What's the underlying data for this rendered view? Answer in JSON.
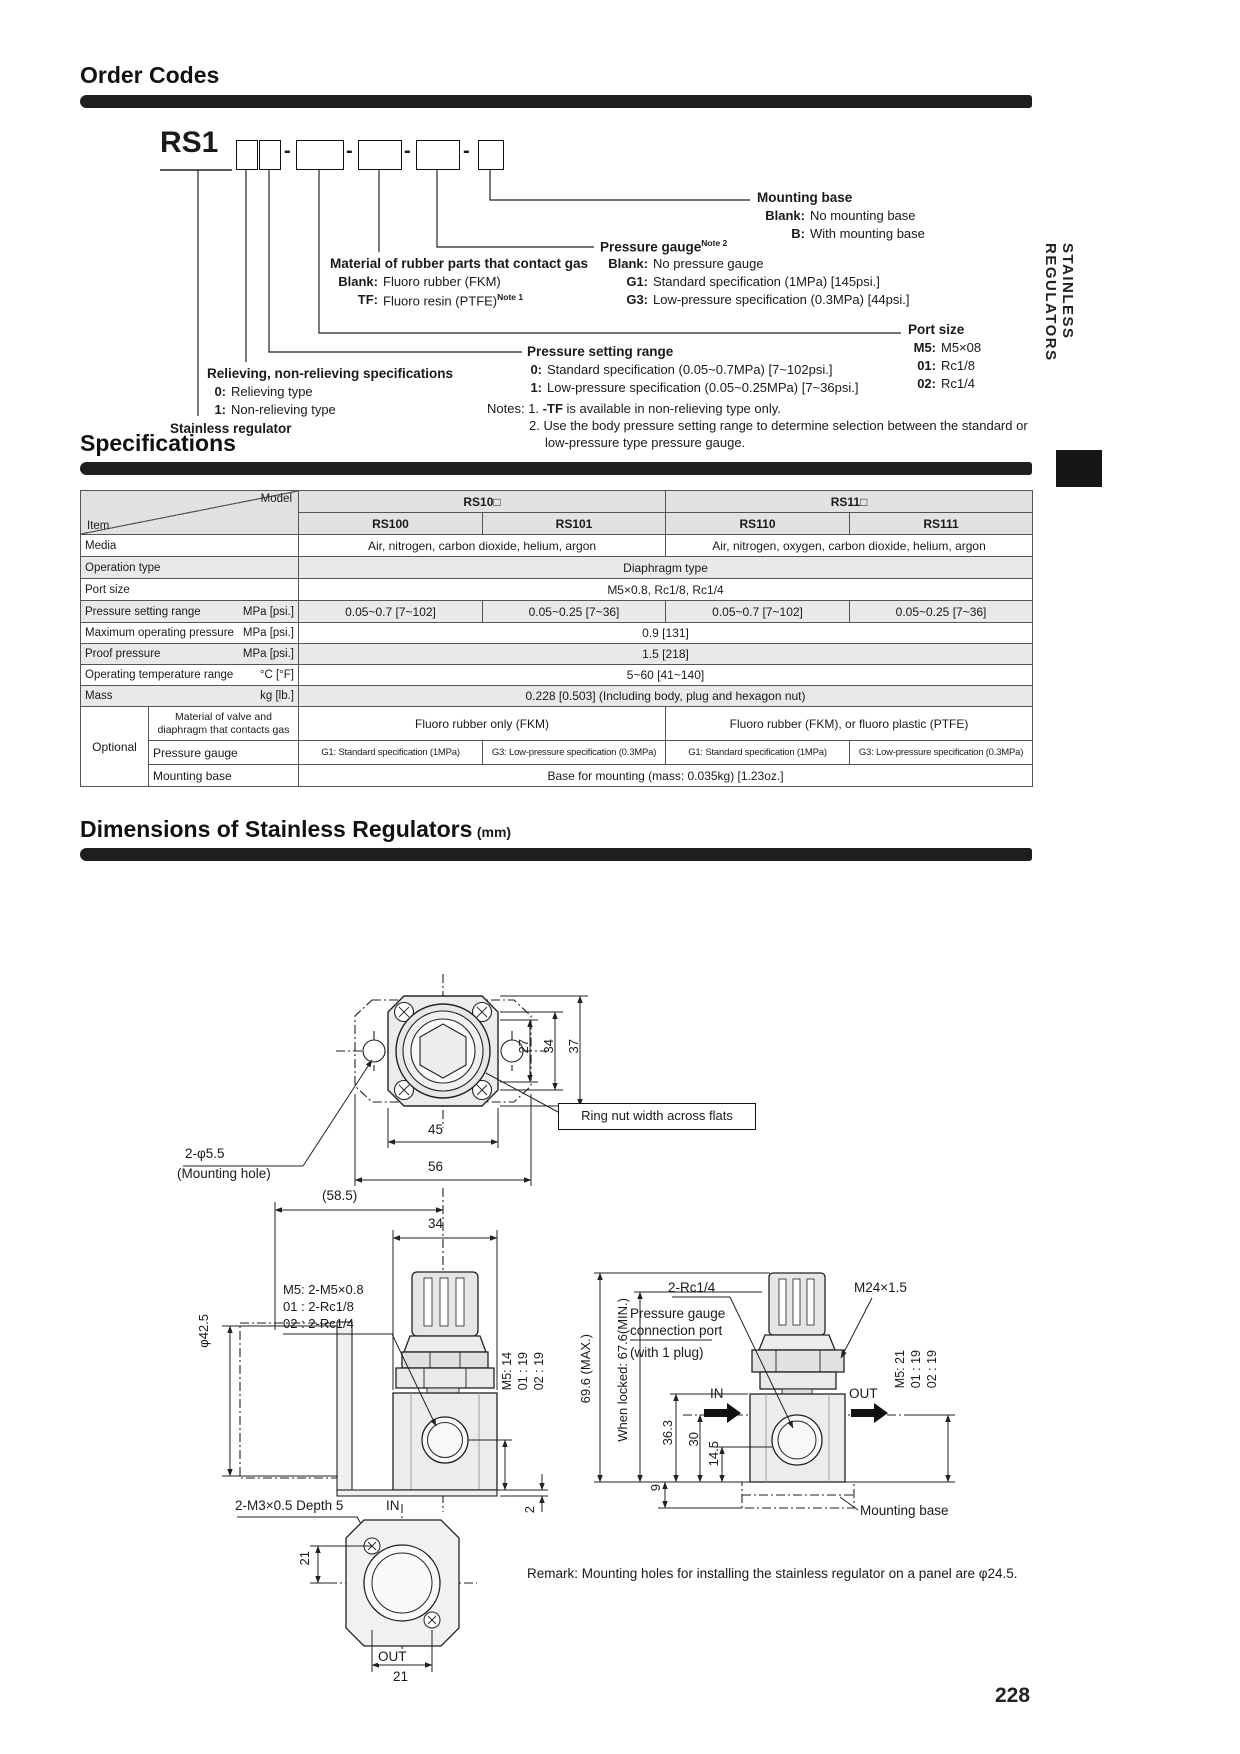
{
  "page": {
    "number": "228",
    "side_tab": "STAINLESS REGULATORS"
  },
  "order": {
    "title": "Order Codes",
    "prefix": "RS1",
    "dash": "-",
    "stainless_label": "Stainless regulator",
    "relieving": {
      "title": "Relieving, non-relieving specifications",
      "opts": [
        {
          "c": "0:",
          "t": "Relieving type"
        },
        {
          "c": "1:",
          "t": "Non-relieving type"
        }
      ]
    },
    "pressure_setting": {
      "title": "Pressure setting range",
      "opts": [
        {
          "c": "0:",
          "t": "Standard specification (0.05~0.7MPa) [7~102psi.]"
        },
        {
          "c": "1:",
          "t": "Low-pressure specification (0.05~0.25MPa) [7~36psi.]"
        }
      ]
    },
    "material": {
      "title": "Material of rubber parts that contact gas",
      "opts": [
        {
          "c": "Blank:",
          "t": "Fluoro rubber (FKM)"
        },
        {
          "c": "TF:",
          "t": "Fluoro resin (PTFE)",
          "sup": "Note 1"
        }
      ]
    },
    "pressure_gauge": {
      "title": "Pressure gauge",
      "sup": "Note 2",
      "opts": [
        {
          "c": "Blank:",
          "t": "No pressure gauge"
        },
        {
          "c": "G1:",
          "t": "Standard specification (1MPa) [145psi.]"
        },
        {
          "c": "G3:",
          "t": "Low-pressure specification (0.3MPa) [44psi.]"
        }
      ]
    },
    "port_size": {
      "title": "Port size",
      "opts": [
        {
          "c": "M5:",
          "t": "M5×08"
        },
        {
          "c": "01:",
          "t": "Rc1/8"
        },
        {
          "c": "02:",
          "t": "Rc1/4"
        }
      ]
    },
    "mounting_base": {
      "title": "Mounting base",
      "opts": [
        {
          "c": "Blank:",
          "t": "No mounting base"
        },
        {
          "c": "B:",
          "t": "With mounting base"
        }
      ]
    },
    "notes": {
      "label": "Notes:",
      "n1_num": "1.",
      "n1_bold": "-TF",
      "n1_rest": "is available in non-relieving type only.",
      "n2_num": "2.",
      "n2_line1": "Use the body pressure setting range to determine selection between the standard or",
      "n2_line2": "low-pressure type pressure gauge."
    }
  },
  "spec": {
    "title": "Specifications",
    "corner": {
      "model": "Model",
      "item": "Item"
    },
    "groups": [
      "RS10□",
      "RS11□"
    ],
    "models": [
      "RS100",
      "RS101",
      "RS110",
      "RS111"
    ],
    "media": {
      "label": "Media",
      "left": "Air, nitrogen, carbon dioxide, helium, argon",
      "right": "Air, nitrogen, oxygen, carbon dioxide, helium, argon"
    },
    "operation": {
      "label": "Operation type",
      "value": "Diaphragm type"
    },
    "port": {
      "label": "Port size",
      "value": "M5×0.8, Rc1/8, Rc1/4"
    },
    "pressure_range": {
      "label": "Pressure setting range",
      "unit": "MPa [psi.]",
      "values": [
        "0.05~0.7 [7~102]",
        "0.05~0.25 [7~36]",
        "0.05~0.7 [7~102]",
        "0.05~0.25 [7~36]"
      ]
    },
    "max_pressure": {
      "label": "Maximum operating pressure",
      "unit": "MPa [psi.]",
      "value": "0.9 [131]"
    },
    "proof_pressure": {
      "label": "Proof pressure",
      "unit": "MPa [psi.]",
      "value": "1.5 [218]"
    },
    "temp_range": {
      "label": "Operating temperature range",
      "unit": "°C [°F]",
      "value": "5~60 [41~140]"
    },
    "mass": {
      "label": "Mass",
      "unit": "kg [lb.]",
      "value": "0.228 [0.503] (Including body, plug and hexagon nut)"
    },
    "optional": {
      "label": "Optional",
      "material": {
        "label": "Material of valve and diaphragm that contacts gas",
        "left": "Fluoro rubber only (FKM)",
        "right": "Fluoro rubber (FKM), or fluoro plastic (PTFE)"
      },
      "gauge": {
        "label": "Pressure gauge",
        "values": [
          "G1: Standard specification (1MPa)",
          "G3: Low-pressure specification (0.3MPa)",
          "G1: Standard specification (1MPa)",
          "G3: Low-pressure specification (0.3MPa)"
        ]
      },
      "base": {
        "label": "Mounting base",
        "value": "Base for mounting (mass: 0.035kg) [1.23oz.]"
      }
    }
  },
  "dims": {
    "title": "Dimensions of Stainless Regulators",
    "unit": "(mm)",
    "top": {
      "d27": "27",
      "d34": "34",
      "d37": "37",
      "d45": "45",
      "d56": "56",
      "ring_nut": "Ring nut width across flats",
      "hole1": "2-φ5.5",
      "hole2": "(Mounting hole)"
    },
    "front": {
      "d585": "(58.5)",
      "d34": "34",
      "port1": "M5: 2-M5×0.8",
      "port2": "01 : 2-Rc1/8",
      "port3": "02 : 2-Rc1/4",
      "dia": "φ42.5",
      "h1": "M5: 14",
      "h2": "01 : 19",
      "h3": "02 : 19",
      "in_label": "IN",
      "depth": "2-M3×0.5 Depth 5",
      "d2": "2"
    },
    "bottom": {
      "d21a": "21",
      "out_label": "OUT",
      "d21b": "21"
    },
    "side": {
      "rc": "2-Rc1/4",
      "m24": "M24×1.5",
      "pg1": "Pressure gauge",
      "pg2": "connection port",
      "pg3": "(with 1 plug)",
      "h696": "69.6 (MAX.)",
      "h676": "When locked: 67.6(MIN.)",
      "d363": "36.3",
      "d30": "30",
      "d145": "14.5",
      "d9": "9",
      "in_label": "IN",
      "out_label": "OUT",
      "h1": "M5: 21",
      "h2": "01 : 19",
      "h3": "02 : 19",
      "base": "Mounting base"
    },
    "remark": "Remark: Mounting holes for installing the stainless regulator on a panel are φ24.5."
  }
}
